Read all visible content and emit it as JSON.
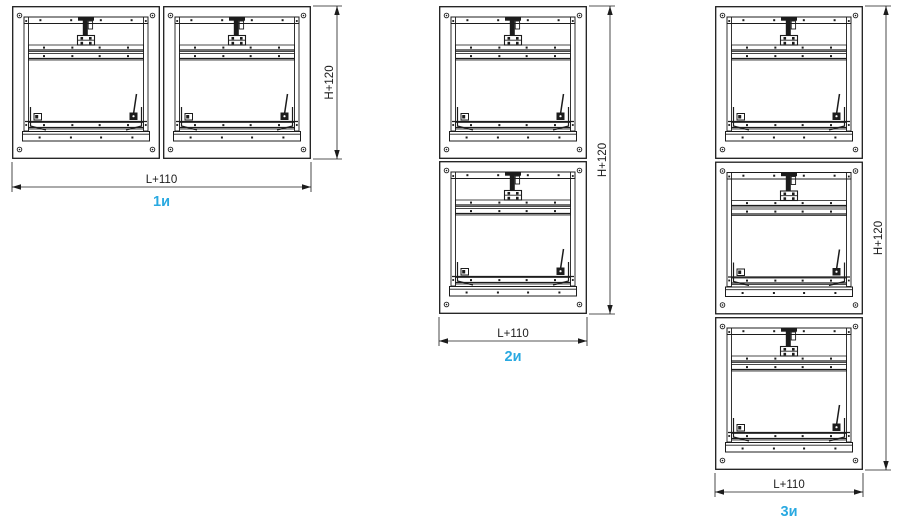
{
  "colors": {
    "line": "#1c1c1c",
    "caption": "#29a9e1",
    "background": "#ffffff"
  },
  "diagrams": [
    {
      "caption": "1и",
      "width_label": "L+110",
      "height_label": "H+120",
      "arrangement": "horizontal",
      "unit_count": 2
    },
    {
      "caption": "2и",
      "width_label": "L+110",
      "height_label": "H+120",
      "arrangement": "vertical",
      "unit_count": 2
    },
    {
      "caption": "3и",
      "width_label": "L+110",
      "height_label": "H+120",
      "arrangement": "vertical",
      "unit_count": 3
    }
  ]
}
